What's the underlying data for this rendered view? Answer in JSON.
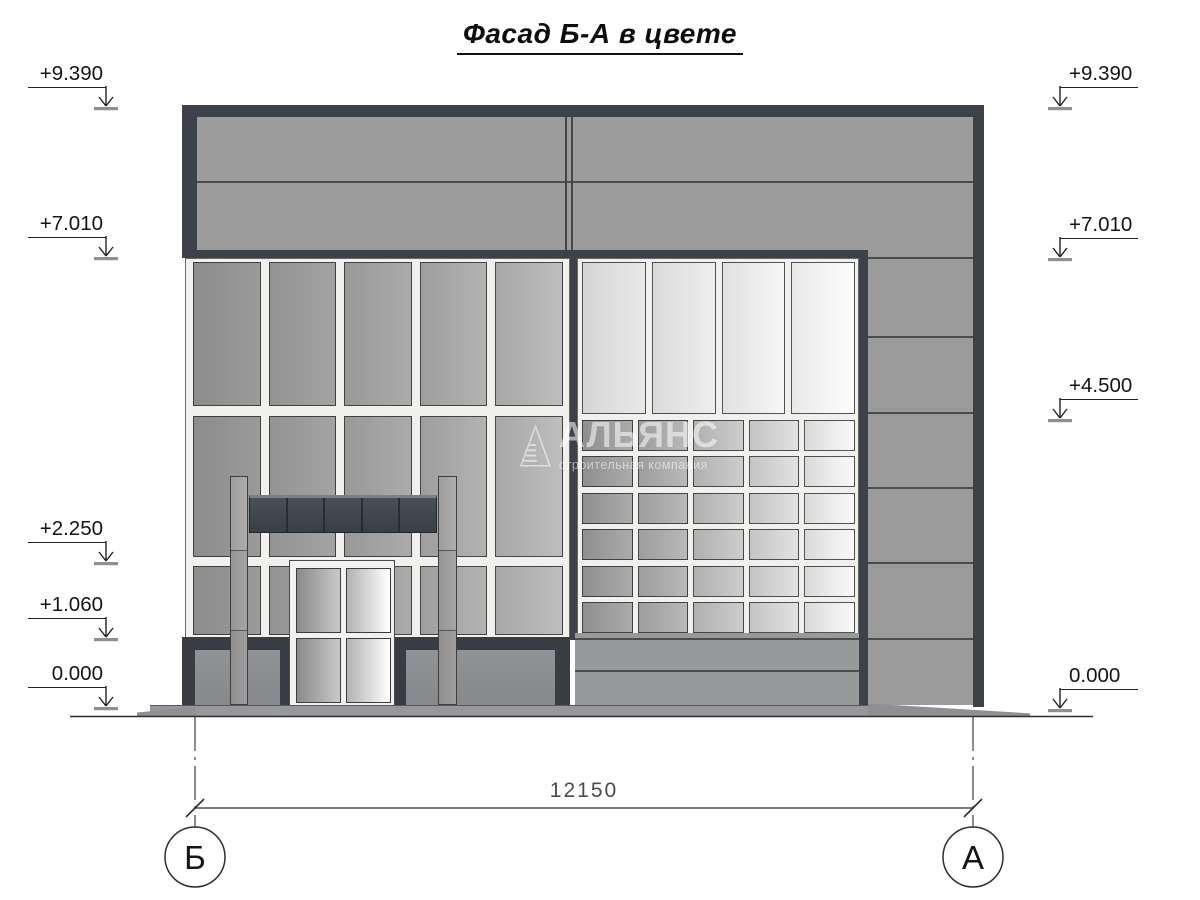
{
  "title": "Фасад Б-А  в цвете",
  "levels_left": [
    "+9.390",
    "+7.010",
    "+2.250",
    "+1.060",
    "0.000"
  ],
  "levels_right": [
    "+9.390",
    "+7.010",
    "+4.500",
    "0.000"
  ],
  "dimension": {
    "span_label": "12150"
  },
  "axes": {
    "left": "Б",
    "right": "А"
  },
  "watermark": {
    "name": "АЛЬЯНС",
    "tagline": "строительная компания"
  },
  "facade": {
    "left_curtainwall_grid": "3x5",
    "right_tall_windows_grid": "1x4",
    "right_small_windows_grid": "6x5",
    "canopy_segments_grid": "1x5",
    "pilaster_joint_count": 6
  },
  "colors": {
    "frame_dark": "#3d424a",
    "parapet_gray": "#9c9c9c",
    "mullion_white": "#f1f0ed",
    "glass_gray": "#9a9a9a",
    "glass_light": "#e9e9e9",
    "plinth_dark": "#383d44",
    "ground_gray": "#96989b",
    "watermark_white": "#ffffff"
  }
}
